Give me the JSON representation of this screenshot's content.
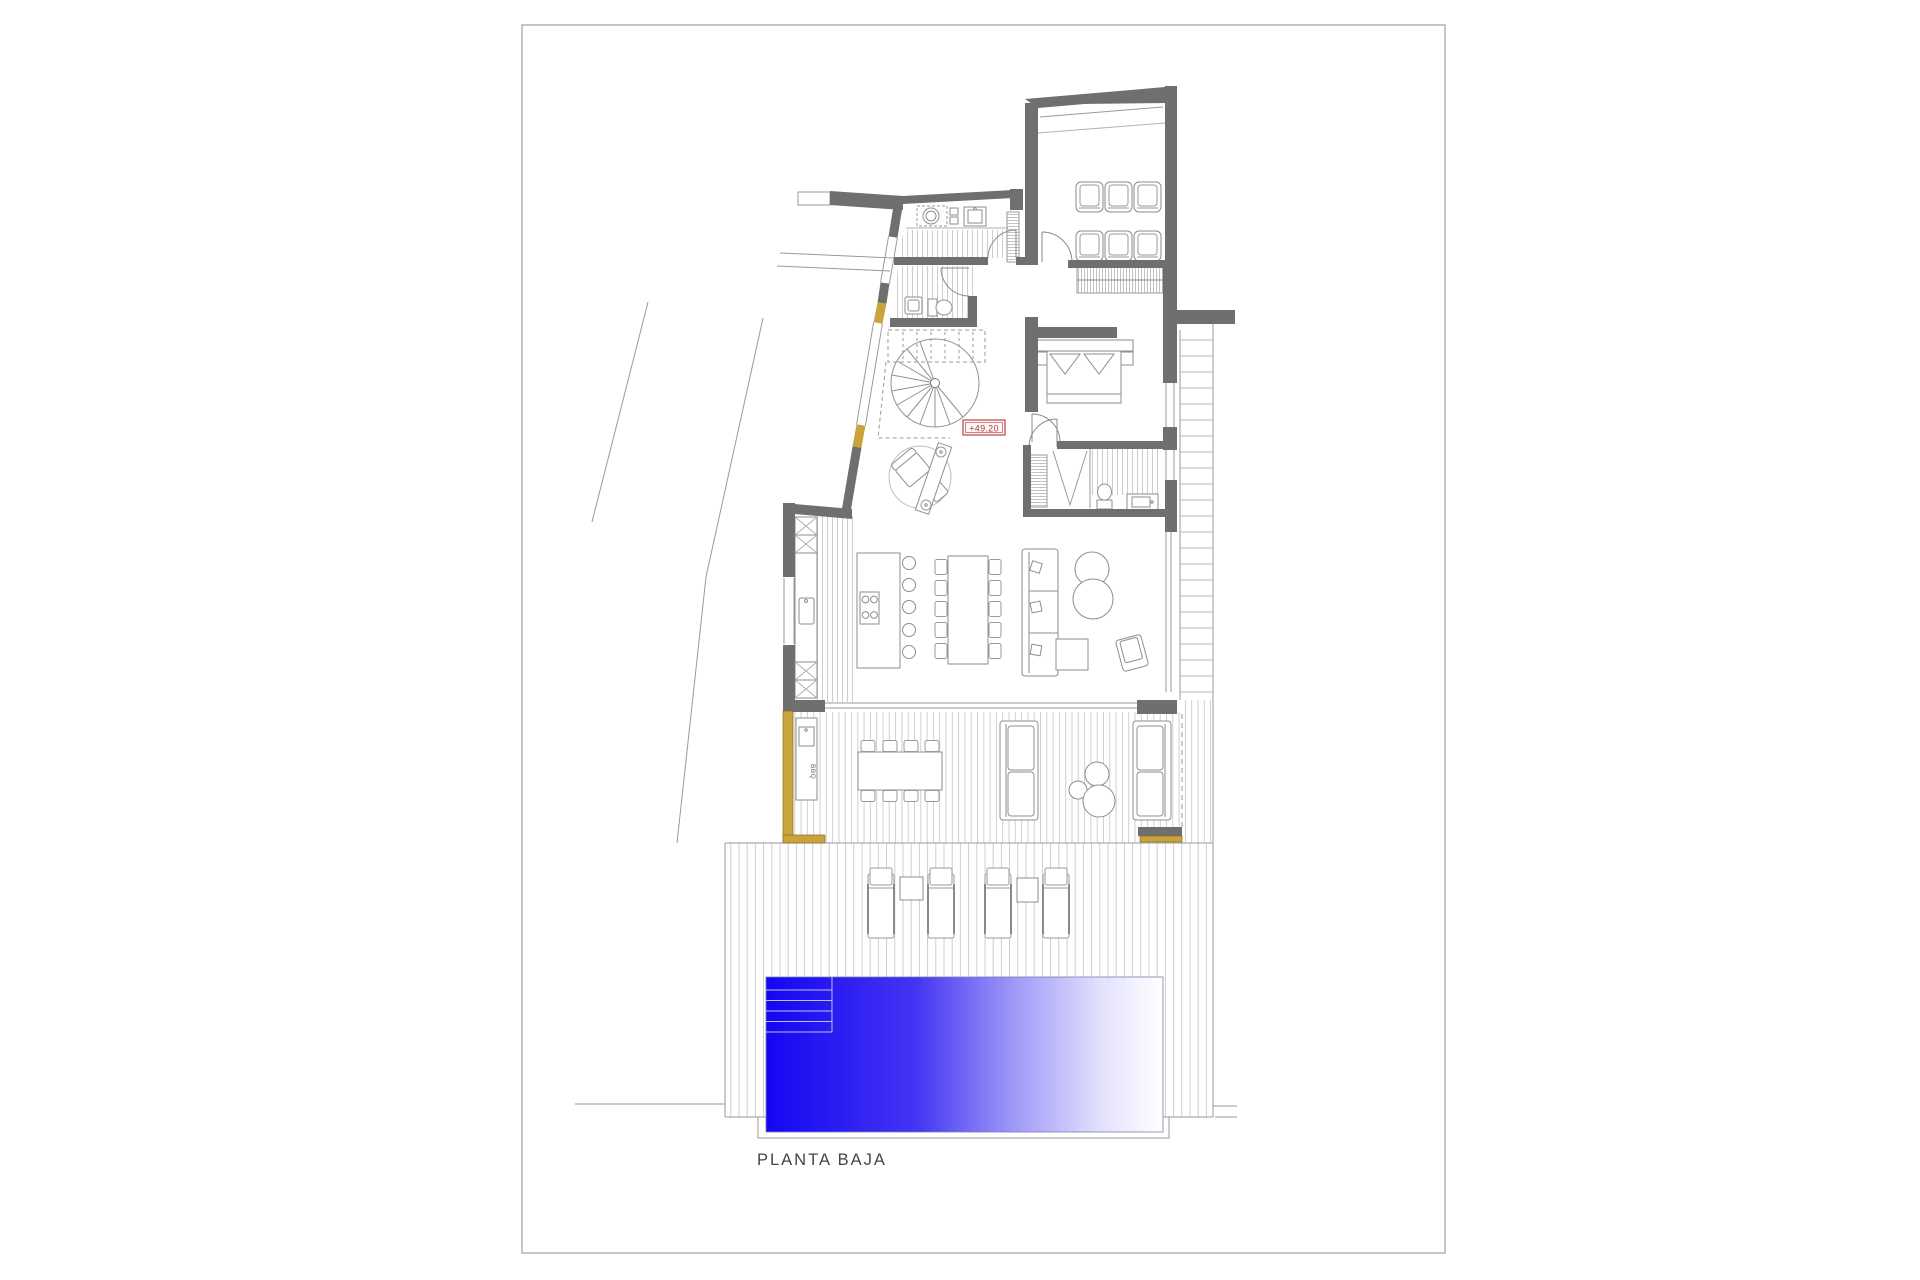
{
  "sheet": {
    "title": "PLANTA BAJA",
    "title_color": "#454545",
    "border_color": "#b4b4b4",
    "background": "#ffffff"
  },
  "annotations": {
    "level_marker": {
      "text": "+49.20",
      "color": "#b23434",
      "fill": "#fdf6f6"
    },
    "bbq_label": {
      "text": "BBQ",
      "color": "#666666"
    }
  },
  "colors": {
    "wall": "#6f6f6f",
    "line": "#8e8e8e",
    "glass": "#9a9a9a",
    "hatch": "#c9c9c9",
    "deck_hatch": "#c2c2c2",
    "accent_yellow": "#c9a43c",
    "accent_yellow_edge": "#8a6d1f",
    "pool_deep": "#1506f2",
    "pool_mid": "#4335f2",
    "pool_light": "#ffffff"
  }
}
